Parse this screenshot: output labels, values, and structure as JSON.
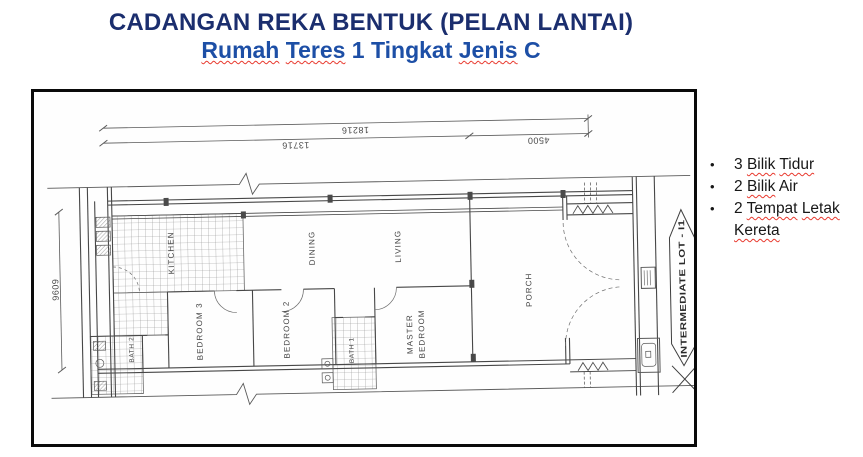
{
  "title": {
    "line1": "CADANGAN REKA BENTUK (PELAN LANTAI)",
    "line2_parts": [
      {
        "t": "Rumah"
      },
      {
        "t": " "
      },
      {
        "t": "Teres"
      },
      {
        "t": " 1 Tingkat "
      },
      {
        "t": "Jenis"
      },
      {
        "t": " C"
      }
    ]
  },
  "plan": {
    "dimensions": {
      "total": "18216",
      "left_segment": "13716",
      "right_segment": "4500",
      "depth": "6096"
    },
    "rooms": {
      "kitchen": "KITCHEN",
      "dining": "DINING",
      "living": "LIVING",
      "porch": "PORCH",
      "bedroom3": "BEDROOM 3",
      "bedroom2": "BEDROOM 2",
      "master_line1": "MASTER",
      "master_line2": "BEDROOM",
      "bath1": "BATH 1",
      "bath2": "BATH 2"
    },
    "lot_label": "INTERMEDIATE LOT - I1"
  },
  "bullets": {
    "glyph": "•",
    "items": [
      {
        "parts": [
          {
            "t": "3 "
          },
          {
            "t": "Bilik"
          },
          {
            "t": " "
          },
          {
            "t": "Tidur"
          }
        ]
      },
      {
        "parts": [
          {
            "t": "2 "
          },
          {
            "t": "Bilik"
          },
          {
            "t": " "
          },
          {
            "t": "Air"
          }
        ]
      },
      {
        "parts": [
          {
            "t": "2 "
          },
          {
            "t": "Tempat"
          },
          {
            "t": " "
          },
          {
            "t": "Letak"
          },
          {
            "t": " "
          },
          {
            "t": "Kereta"
          }
        ]
      }
    ]
  },
  "colors": {
    "title_line1": "#1b2e6e",
    "title_line2": "#1d4fa6",
    "squiggle": "#e8392e",
    "ink": "#575757",
    "frame": "#0a0a0a"
  }
}
